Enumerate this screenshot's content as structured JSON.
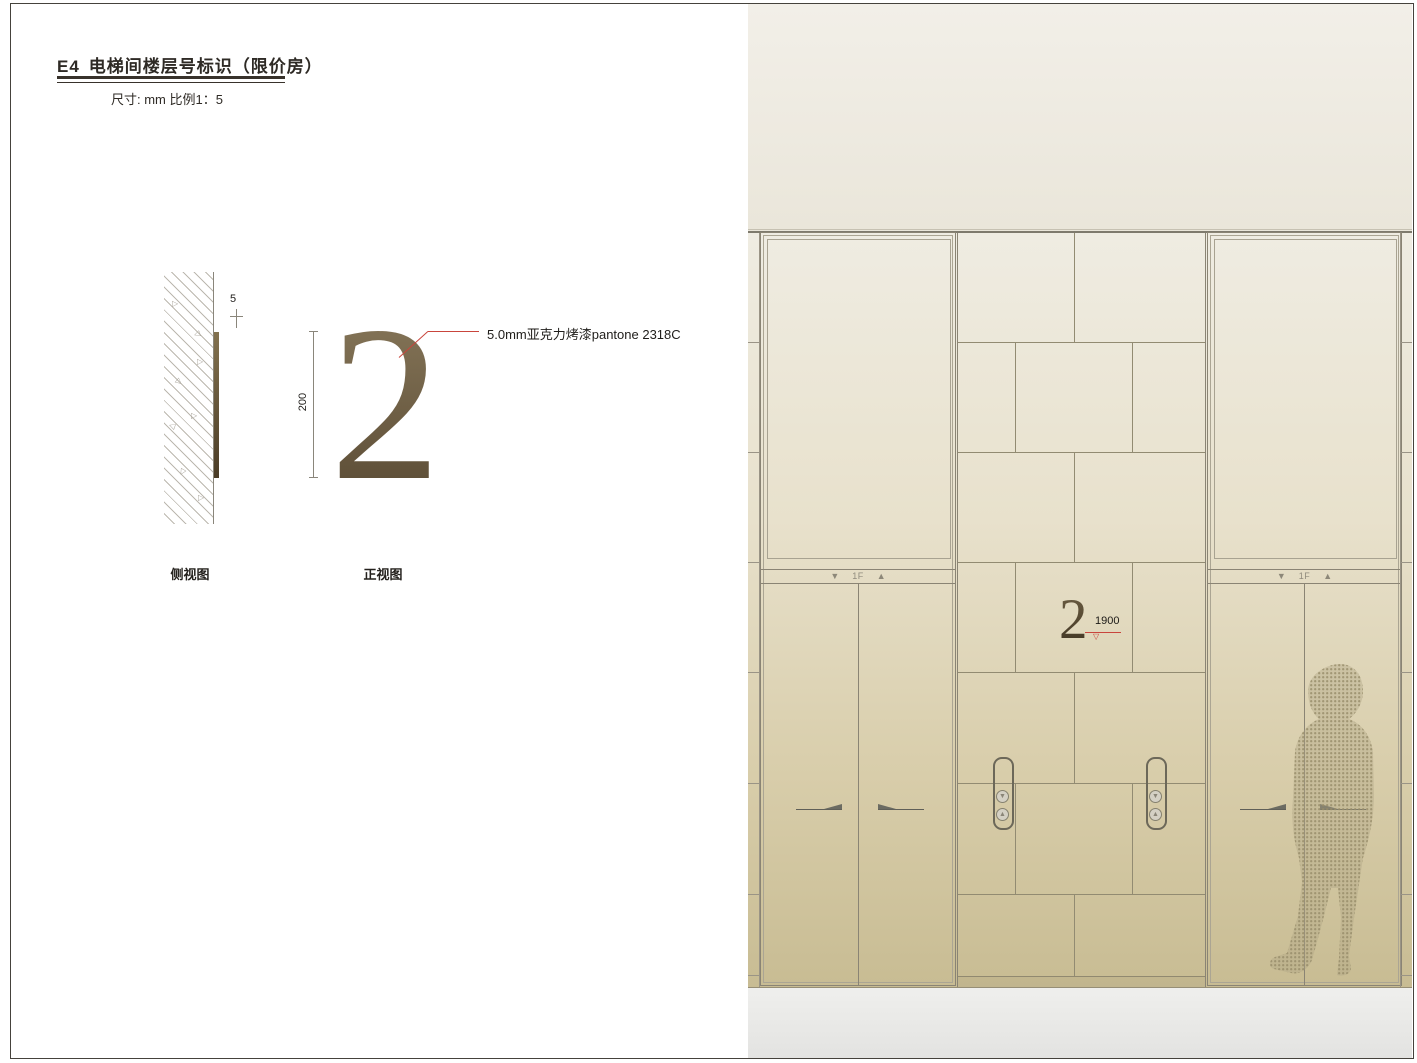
{
  "header": {
    "code": "E4",
    "title": "电梯间楼层号标识（限价房）",
    "subtitle": "尺寸: mm  比例1：5"
  },
  "side_view": {
    "label": "侧视图",
    "thickness_dim": "5",
    "hatch_glyph": "▷"
  },
  "front_view": {
    "label": "正视图",
    "numeral": "2",
    "height_dim": "200",
    "annotation": "5.0mm亚克力烤漆pantone 2318C"
  },
  "rendering": {
    "sign_numeral": "2",
    "mounting_height": "1900",
    "level_mark_glyph": "▽",
    "elevators": {
      "left": {
        "down_arrow": "▼",
        "floor_label": "1F",
        "up_arrow": "▲"
      },
      "right": {
        "down_arrow": "▼",
        "floor_label": "1F",
        "up_arrow": "▲"
      }
    },
    "call_panel": {
      "down_glyph": "▼",
      "up_glyph": "▲"
    }
  },
  "colors": {
    "numeral_gradient_top": "#8c7c5e",
    "numeral_gradient_bottom": "#554630",
    "sign_gradient_top": "#6f6045",
    "sign_gradient_bottom": "#3e3321",
    "annotation_leader": "#c9453c",
    "ceiling": "#f2efe8",
    "wall_top": "#efece2",
    "wall_bottom": "#c8bc93",
    "floor": "#ececea",
    "drawing_line": "#8a8474"
  }
}
